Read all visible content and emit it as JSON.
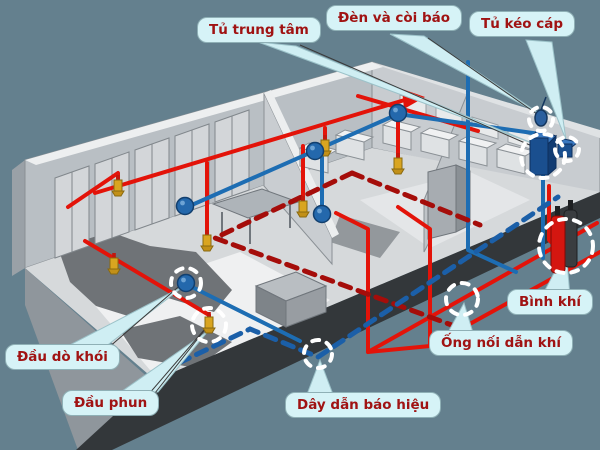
{
  "figure": {
    "description": "Isometric cutaway diagram of a room fire alarm and gas suppression system",
    "background_color": "#64808e",
    "labels": {
      "central_panel": "Tủ trung tâm",
      "alarm_light_siren": "Đèn và còi báo",
      "cable_pull_box": "Tủ kéo cáp",
      "gas_cylinder": "Bình khí",
      "gas_connector_pipe": "Ống nối dẫn khí",
      "signal_wire": "Dây dẫn báo hiệu",
      "spray_nozzle": "Đầu phun",
      "smoke_detector": "Đầu dò khói"
    },
    "colors": {
      "pipe_red": "#e31309",
      "pipe_blue": "#1d6db3",
      "dashed_red": "#a50d0a",
      "dashed_blue": "#1b5fa8",
      "nozzle_gold": "#d9a520",
      "detector_blue": "#2468ac",
      "cabinet_blue": "#1a4f8f",
      "cylinder_red": "#d41610",
      "cylinder_dark": "#3a3d40",
      "highlight_circle": "#ffffff",
      "bubble_fill": "#d6f3f7",
      "bubble_border": "#8fb0b6",
      "label_text": "#a01313"
    }
  }
}
